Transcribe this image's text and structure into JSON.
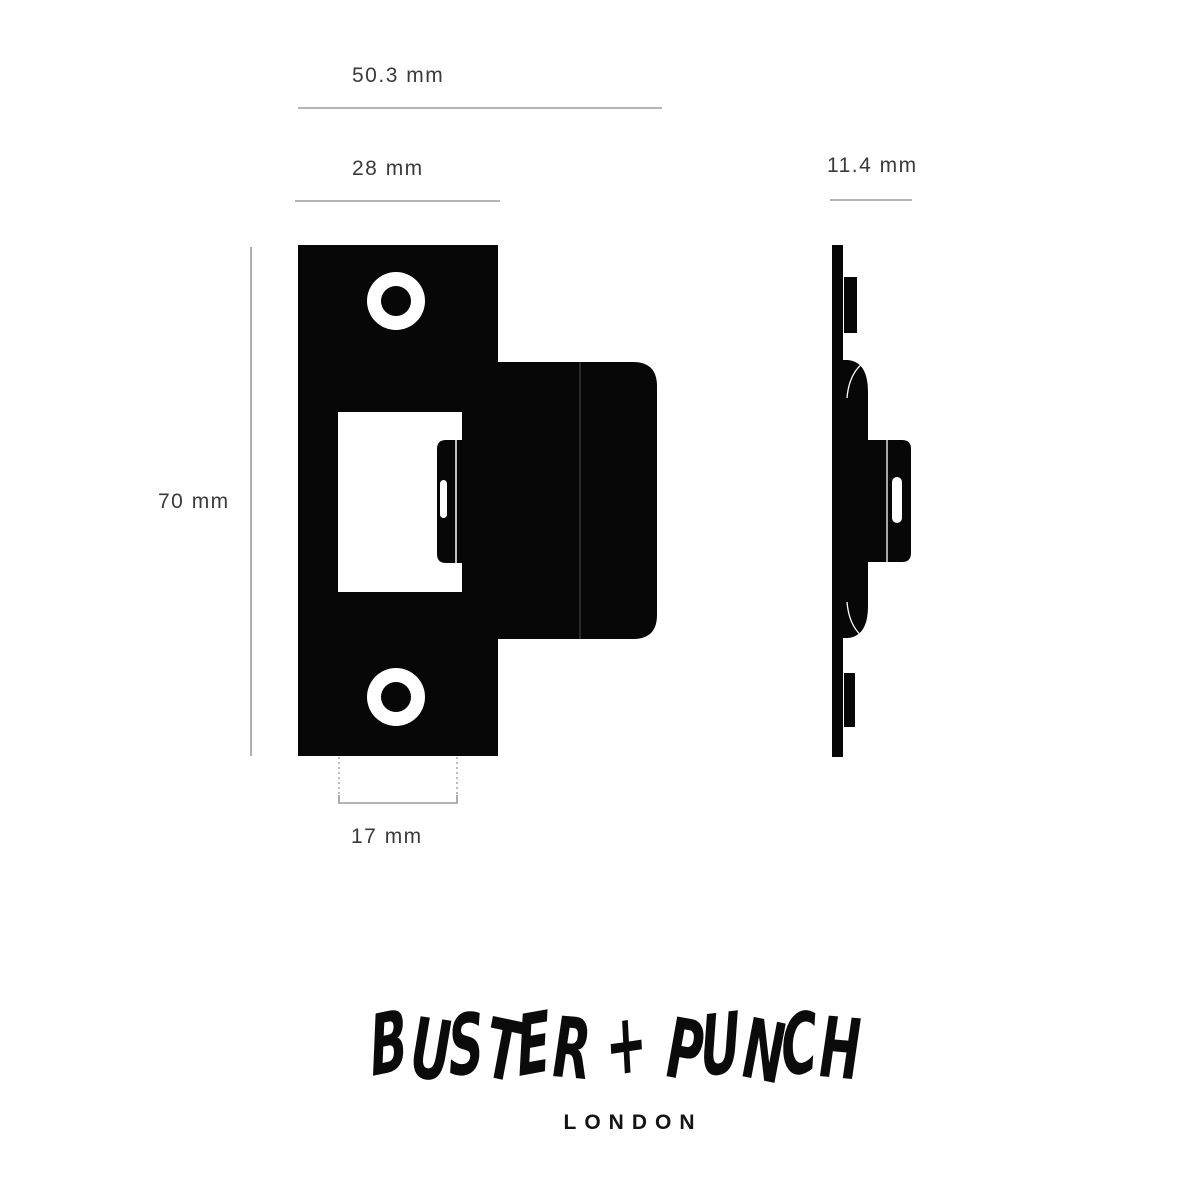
{
  "diagram": {
    "dimension_labels": {
      "overall_width": "50.3 mm",
      "faceplate_width": "28 mm",
      "side_depth": "11.4 mm",
      "faceplate_height": "70 mm",
      "bolt_width": "17 mm"
    },
    "colors": {
      "ink": "#070707",
      "dimension_line": "#9b9b9b",
      "dotted_guide": "#8f8f8f",
      "dimension_text": "#3a3a3a",
      "cutout": "#ffffff",
      "background": "#ffffff"
    }
  },
  "logo": {
    "wordmark": "BUSTER + PUNCH",
    "city": "LONDON"
  }
}
